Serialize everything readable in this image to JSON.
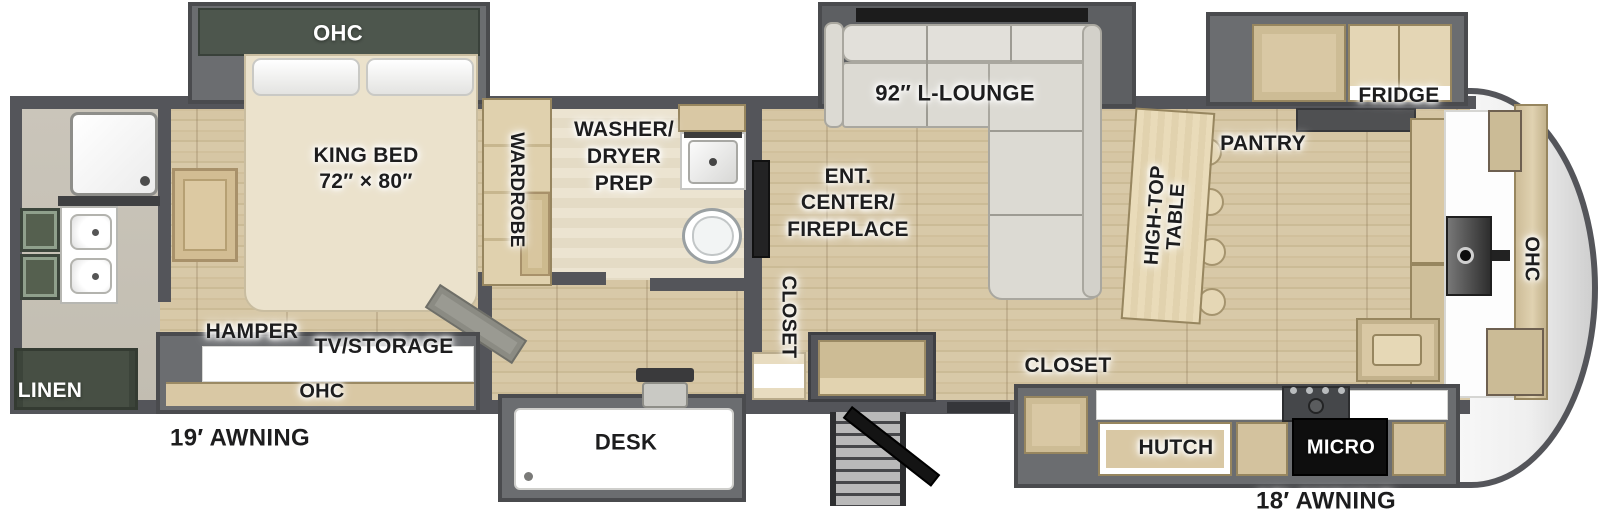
{
  "bedroom": {
    "ohc": "OHC",
    "bed_title": "KING BED",
    "bed_size": "72″ × 80″",
    "wardrobe": "WARDROBE",
    "hamper": "HAMPER",
    "tv_storage": "TV/STORAGE",
    "ohc_bottom": "OHC"
  },
  "bath": {
    "linen": "LINEN"
  },
  "laundry": {
    "line1": "WASHER/",
    "line2": "DRYER",
    "line3": "PREP"
  },
  "hall": {
    "closet_vertical": "CLOSET"
  },
  "living": {
    "lounge": "92″ L-LOUNGE",
    "ent_line1": "ENT.",
    "ent_line2": "CENTER/",
    "ent_line3": "FIREPLACE",
    "desk": "DESK"
  },
  "kitchen": {
    "hightop_line1": "HIGH-TOP",
    "hightop_line2": "TABLE",
    "pantry": "PANTRY",
    "fridge": "FRIDGE",
    "closet": "CLOSET",
    "hutch": "HUTCH",
    "micro": "MICRO",
    "ohc_front": "OHC"
  },
  "exterior": {
    "awning_offdoor": "19′ AWNING",
    "awning_door": "18′ AWNING"
  },
  "colors": {
    "wall": "#54555a",
    "slide_box": "#6b6d70",
    "wood_floor": "#d5c5a4",
    "cabinet_wood": "#d9c8a4",
    "cabinet_dark_green": "#4d564d",
    "sofa": "#dcdad3",
    "counter_white": "#ffffff",
    "micro_black": "#0e0e0e",
    "front_cap": "#e9e9e9"
  }
}
